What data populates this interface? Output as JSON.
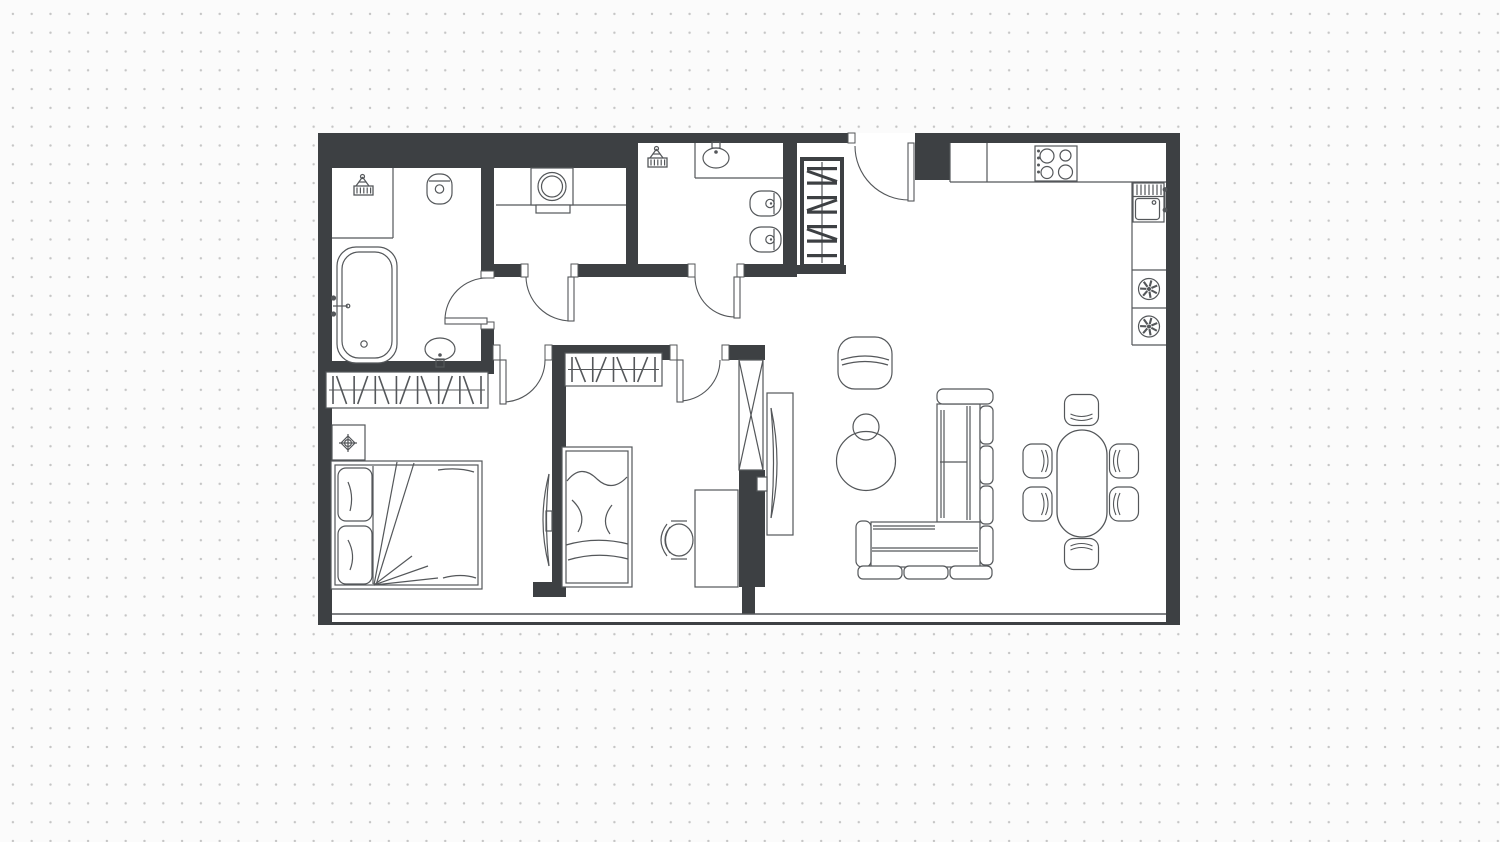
{
  "palette": {
    "page_bg": "#fbfbfb",
    "dot": "#c5c5c5",
    "wall": "#3d4043",
    "line": "#54575a",
    "floor": "#ffffff"
  },
  "plan": {
    "x": 318,
    "y": 133,
    "w": 862,
    "h": 492
  },
  "walls": [
    [
      318,
      133,
      14,
      492
    ],
    [
      318,
      133,
      315,
      35
    ],
    [
      626,
      133,
      229,
      10
    ],
    [
      915,
      133,
      35,
      47
    ],
    [
      950,
      133,
      230,
      10
    ],
    [
      1166,
      133,
      14,
      492
    ],
    [
      481,
      133,
      13,
      145
    ],
    [
      481,
      322,
      13,
      52
    ],
    [
      626,
      143,
      12,
      134
    ],
    [
      783,
      133,
      14,
      144
    ],
    [
      481,
      264,
      47,
      13
    ],
    [
      571,
      264,
      124,
      13
    ],
    [
      737,
      264,
      60,
      13
    ],
    [
      797,
      265,
      49,
      9
    ],
    [
      318,
      361,
      176,
      13
    ],
    [
      481,
      345,
      19,
      15
    ],
    [
      545,
      345,
      132,
      15
    ],
    [
      722,
      345,
      43,
      15
    ],
    [
      552,
      358,
      14,
      239
    ],
    [
      533,
      582,
      33,
      15
    ],
    [
      739,
      470,
      26,
      117
    ],
    [
      742,
      587,
      13,
      27
    ]
  ],
  "window_band": {
    "inner": [
      332,
      614,
      1166,
      614
    ],
    "outer": [
      318,
      623.5,
      1180,
      623.5
    ],
    "inner_w": 1.4,
    "outer_w": 3
  },
  "rooms": [
    {
      "name": "bathroom-1",
      "x": 332,
      "y": 168,
      "w": 149,
      "h": 193
    },
    {
      "name": "laundry-room",
      "x": 494,
      "y": 168,
      "w": 132,
      "h": 96
    },
    {
      "name": "bathroom-2",
      "x": 638,
      "y": 143,
      "w": 145,
      "h": 121
    },
    {
      "name": "entry-hall",
      "x": 800,
      "y": 143,
      "w": 115,
      "h": 130
    },
    {
      "name": "kitchen",
      "x": 950,
      "y": 143,
      "w": 216,
      "h": 202
    },
    {
      "name": "hallway",
      "x": 494,
      "y": 277,
      "w": 271,
      "h": 68
    },
    {
      "name": "master-bedroom",
      "x": 332,
      "y": 374,
      "w": 220,
      "h": 240
    },
    {
      "name": "bedroom-2",
      "x": 566,
      "y": 360,
      "w": 173,
      "h": 254
    },
    {
      "name": "living-dining-room",
      "x": 765,
      "y": 277,
      "w": 401,
      "h": 337
    }
  ],
  "doors": [
    {
      "name": "entry-door",
      "jambs": [
        [
          848,
          133,
          7,
          10
        ]
      ],
      "leaf": [
        908,
        143,
        6,
        58
      ],
      "arc": "M855,146 A54,54 0 0 0 909,200"
    },
    {
      "name": "laundry-door",
      "jambs": [
        [
          521,
          264,
          7,
          13
        ],
        [
          571,
          264,
          7,
          13
        ]
      ],
      "leaf": [
        568,
        277,
        6,
        44
      ],
      "arc": "M526,277 A45,45 0 0 0 571,321"
    },
    {
      "name": "bathroom2-door",
      "jambs": [
        [
          688,
          264,
          7,
          13
        ],
        [
          737,
          264,
          7,
          13
        ]
      ],
      "leaf": [
        734,
        277,
        6,
        41
      ],
      "arc": "M695,277 A40,40 0 0 0 735,317"
    },
    {
      "name": "master-bedroom-door",
      "jambs": [
        [
          493,
          345,
          7,
          15
        ],
        [
          545,
          345,
          7,
          15
        ]
      ],
      "leaf": [
        500,
        360,
        6,
        44
      ],
      "arc": "M545,360 A42,42 0 0 1 503,402"
    },
    {
      "name": "bedroom2-door",
      "jambs": [
        [
          670,
          345,
          7,
          15
        ],
        [
          722,
          345,
          7,
          15
        ]
      ],
      "leaf": [
        677,
        360,
        6,
        42
      ],
      "arc": "M720,360 A41,41 0 0 1 679,401"
    },
    {
      "name": "bathroom1-door",
      "jambs": [
        [
          481,
          271,
          13,
          7
        ],
        [
          481,
          322,
          13,
          7
        ]
      ],
      "leaf": [
        445,
        318,
        42,
        6
      ],
      "arc": "M445,320 A42,42 0 0 1 487,278"
    }
  ],
  "furniture": [
    {
      "type": "shower",
      "name": "shower-head-1",
      "x": 352,
      "y": 174
    },
    {
      "type": "composite",
      "name": "shower-screen-1",
      "lines": [
        [
          393,
          168,
          393,
          238
        ],
        [
          332,
          238,
          393,
          238
        ]
      ]
    },
    {
      "type": "composite",
      "name": "toilet-1",
      "fill": "#ffffff",
      "rrects": [
        [
          427,
          174,
          25,
          30,
          11
        ]
      ],
      "lines": [
        [
          429,
          181,
          450,
          181
        ]
      ],
      "circles": [
        [
          439.5,
          189,
          4.2
        ]
      ]
    },
    {
      "type": "composite",
      "name": "bathtub",
      "fill": "#ffffff",
      "rrects": [
        [
          337,
          247,
          60,
          116,
          19
        ],
        [
          342,
          252,
          50,
          106,
          17
        ]
      ],
      "circles": [
        [
          364,
          344,
          3.2
        ],
        [
          348,
          306,
          1.8
        ]
      ],
      "lines": [
        [
          333,
          306,
          348,
          306
        ]
      ],
      "dots": [
        [
          333.5,
          298,
          2.6
        ],
        [
          333.5,
          314,
          2.6
        ]
      ]
    },
    {
      "type": "composite",
      "name": "sink-1",
      "ellipses": [
        [
          440,
          349,
          15,
          11
        ]
      ],
      "rects": [
        [
          436,
          359,
          8,
          8
        ]
      ],
      "dots": [
        [
          440,
          355,
          1.8
        ]
      ]
    },
    {
      "type": "composite",
      "name": "laundry-counter",
      "lines": [
        [
          496,
          205,
          626,
          205
        ]
      ]
    },
    {
      "type": "composite",
      "name": "washing-machine",
      "fill": "#ffffff",
      "rects": [
        [
          531,
          168,
          42,
          37
        ],
        [
          536,
          205,
          34,
          8
        ]
      ],
      "circles": [
        [
          552,
          186.5,
          14
        ],
        [
          552,
          186.5,
          10.5
        ]
      ]
    },
    {
      "type": "shower",
      "name": "shower-head-2",
      "x": 646,
      "y": 146
    },
    {
      "type": "composite",
      "name": "bathroom2-partition",
      "lines": [
        [
          695,
          143,
          695,
          178
        ],
        [
          695,
          178,
          783,
          178
        ]
      ]
    },
    {
      "type": "composite",
      "name": "sink-2",
      "ellipses": [
        [
          716,
          158,
          13,
          10
        ]
      ],
      "rects": [
        [
          712,
          142,
          8,
          6
        ]
      ],
      "dots": [
        [
          716,
          152,
          1.8
        ]
      ]
    },
    {
      "type": "composite",
      "name": "toilet-2",
      "fill": "#ffffff",
      "rrects": [
        [
          750,
          191,
          31,
          25,
          11
        ]
      ],
      "lines": [
        [
          774,
          193,
          774,
          214
        ]
      ],
      "circles": [
        [
          770,
          203.5,
          4.2
        ]
      ],
      "dots": [
        [
          771,
          203.5,
          1.2
        ]
      ]
    },
    {
      "type": "composite",
      "name": "bidet",
      "fill": "#ffffff",
      "rrects": [
        [
          750,
          227,
          31,
          25,
          11
        ]
      ],
      "lines": [
        [
          774,
          229,
          774,
          250
        ]
      ],
      "circles": [
        [
          770,
          239.5,
          4.2
        ]
      ],
      "dots": [
        [
          771,
          239.5,
          1.2
        ]
      ]
    },
    {
      "type": "shoe_rack",
      "name": "hallway-shoe-rack",
      "x": 800,
      "y": 157,
      "w": 44,
      "h": 111
    },
    {
      "type": "composite",
      "name": "kitchen-counter",
      "lines": [
        [
          950,
          143,
          950,
          182
        ],
        [
          950,
          182,
          1166,
          182
        ],
        [
          987,
          143,
          987,
          182
        ],
        [
          1132,
          182,
          1132,
          345
        ],
        [
          1132,
          345,
          1166,
          345
        ],
        [
          1132,
          270,
          1166,
          270
        ],
        [
          1132,
          308,
          1166,
          308
        ]
      ]
    },
    {
      "type": "composite",
      "name": "cooktop",
      "fill": "#ffffff",
      "rects": [
        [
          1035,
          146,
          42,
          35
        ]
      ],
      "circles": [
        [
          1047,
          156,
          7
        ],
        [
          1065.5,
          155.5,
          5.5
        ],
        [
          1047,
          172.5,
          6
        ],
        [
          1065.5,
          172,
          7
        ]
      ],
      "dots": [
        [
          1038.5,
          151,
          1.5
        ],
        [
          1038.5,
          158,
          1.5
        ],
        [
          1038.5,
          165,
          1.5
        ],
        [
          1038.5,
          172,
          1.5
        ]
      ]
    },
    {
      "type": "composite",
      "name": "kitchen-sink",
      "fill": "#ffffff",
      "rects": [
        [
          1133,
          183,
          31,
          39
        ]
      ],
      "rrects": [
        [
          1135.5,
          198.5,
          24,
          21,
          3
        ]
      ],
      "lines": [
        [
          1133,
          196.5,
          1164,
          196.5
        ],
        [
          1137,
          184.5,
          1137,
          195
        ],
        [
          1141,
          184.5,
          1141,
          195
        ],
        [
          1145,
          184.5,
          1145,
          195
        ],
        [
          1149,
          184.5,
          1149,
          195
        ],
        [
          1153,
          184.5,
          1153,
          195
        ],
        [
          1157,
          184.5,
          1157,
          195
        ],
        [
          1161,
          184.5,
          1161,
          195
        ],
        [
          1165,
          190,
          1165,
          210
        ]
      ],
      "circles": [
        [
          1154,
          202.5,
          1.8
        ]
      ],
      "dots": [
        [
          1165,
          189.5,
          2.4
        ],
        [
          1165,
          210,
          2.4
        ]
      ]
    },
    {
      "type": "fan",
      "name": "appliance-fan-1",
      "cx": 1149,
      "cy": 289,
      "r": 10.5
    },
    {
      "type": "fan",
      "name": "appliance-fan-2",
      "cx": 1149,
      "cy": 326.5,
      "r": 10.5
    },
    {
      "type": "wardrobe",
      "name": "master-wardrobe",
      "x": 326,
      "y": 372,
      "w": 162,
      "h": 36
    },
    {
      "type": "composite",
      "name": "nightstand-lamp",
      "fill": "#ffffff",
      "rects": [
        [
          332,
          425,
          33,
          35
        ]
      ],
      "paths": [
        "M348,436 L355,443 L348,450 L341,443 Z"
      ],
      "lines": [
        [
          348,
          434,
          348,
          452
        ],
        [
          339,
          443,
          357,
          443
        ]
      ],
      "circles": [
        [
          348,
          443,
          3.4
        ]
      ]
    },
    {
      "type": "composite",
      "name": "double-bed",
      "fill": "#ffffff",
      "rects": [
        [
          331,
          461,
          151,
          128
        ],
        [
          335,
          465,
          143,
          120
        ]
      ],
      "rrects": [
        [
          338,
          468,
          34,
          53,
          8
        ],
        [
          338,
          526,
          34,
          58,
          8
        ]
      ],
      "lines": [
        [
          373,
          466,
          373,
          584
        ]
      ],
      "paths": [
        "M397,462 L374,585",
        "M414,463 L376,585",
        "M374,585 L412,556",
        "M374,585 L428,566",
        "M374,585 L438,578",
        "M348,482 Q354,496 350,511",
        "M348,540 Q356,555 350,570",
        "M438,470 Q458,467 474,472",
        "M443,578 Q461,573 476,578"
      ]
    },
    {
      "type": "composite",
      "name": "master-tv",
      "fill": "#ffffff",
      "rects": [
        [
          546,
          511,
          6,
          20
        ]
      ],
      "paths": [
        "M549,474 Q537,520 549,566",
        "M549,474 Q544,520 549,566"
      ]
    },
    {
      "type": "wardrobe",
      "name": "bedroom2-wardrobe",
      "x": 565,
      "y": 353,
      "w": 97,
      "h": 33
    },
    {
      "type": "composite",
      "name": "single-bed",
      "fill": "#ffffff",
      "rects": [
        [
          562,
          447,
          70,
          140
        ],
        [
          566,
          451,
          62,
          132
        ]
      ],
      "paths": [
        "M567,481 Q581,463 597,479 Q612,493 627,477",
        "M566,545 Q597,536 628,544",
        "M568,560 Q598,551 628,559",
        "M572,500 Q588,515 578,532",
        "M612,505 Q600,520 610,534"
      ]
    },
    {
      "type": "composite",
      "name": "desk",
      "fill": "#ffffff",
      "rects": [
        [
          695,
          490,
          43,
          97
        ]
      ]
    },
    {
      "type": "composite",
      "name": "desk-chair",
      "fill": "#ffffff",
      "ellipses": [
        [
          679,
          540,
          14,
          16
        ]
      ],
      "paths": [
        "M667,524 Q655,540 667,556",
        "M670,527 Q661,540 670,553"
      ],
      "lines": [
        [
          671,
          521,
          687,
          521
        ],
        [
          671,
          559,
          687,
          559
        ]
      ]
    },
    {
      "type": "composite",
      "name": "built-in-closet",
      "fill": "#ffffff",
      "rects": [
        [
          739,
          360,
          24,
          110
        ]
      ],
      "lines": [
        [
          739,
          360,
          763,
          470
        ],
        [
          763,
          360,
          739,
          470
        ]
      ]
    },
    {
      "type": "composite",
      "name": "living-tv",
      "fill": "#ffffff",
      "rects": [
        [
          767,
          393,
          26,
          142
        ],
        [
          757,
          477,
          10,
          14
        ]
      ],
      "paths": [
        "M771,408 Q783,463 771,518",
        "M771,408 Q776,463 771,518"
      ]
    },
    {
      "type": "composite",
      "name": "armchair",
      "fill": "#ffffff",
      "rrects": [
        [
          838,
          337,
          54,
          52,
          17
        ]
      ],
      "paths": [
        "M841,360 Q865,352 889,360",
        "M842,365 Q865,358 888,365"
      ]
    },
    {
      "type": "composite",
      "name": "coffee-tables",
      "circles": [
        [
          866,
          461,
          29.5
        ],
        [
          866,
          427,
          13
        ]
      ]
    },
    {
      "type": "composite",
      "name": "corner-sofa",
      "fill": "#ffffff",
      "rects": [
        [
          937,
          404,
          43,
          118
        ],
        [
          871,
          522,
          109,
          45
        ]
      ],
      "rrects": [
        [
          937,
          389,
          56,
          15,
          6
        ],
        [
          856,
          521,
          15,
          46,
          6
        ],
        [
          980,
          406,
          13,
          38,
          5
        ],
        [
          980,
          446,
          13,
          38,
          5
        ],
        [
          980,
          486,
          13,
          38,
          5
        ],
        [
          980,
          526,
          13,
          39,
          5
        ],
        [
          858,
          566,
          44,
          13,
          5
        ],
        [
          904,
          566,
          44,
          13,
          5
        ],
        [
          950,
          566,
          42,
          13,
          5
        ]
      ],
      "lines": [
        [
          941,
          410,
          941,
          518
        ],
        [
          944,
          410,
          944,
          518
        ],
        [
          967,
          406,
          967,
          520
        ],
        [
          970,
          406,
          970,
          520
        ],
        [
          873,
          526,
          935,
          526
        ],
        [
          873,
          529,
          935,
          529
        ],
        [
          872,
          548,
          978,
          548
        ],
        [
          872,
          551,
          978,
          551
        ],
        [
          940,
          462,
          967,
          462
        ]
      ]
    },
    {
      "type": "dining_set",
      "name": "dining-set",
      "table": [
        1057,
        430,
        50,
        107
      ],
      "chairs": [
        [
          1081.5,
          410,
          "down"
        ],
        [
          1081.5,
          554,
          "up"
        ],
        [
          1037.5,
          461,
          "right"
        ],
        [
          1037.5,
          504,
          "right"
        ],
        [
          1124,
          461,
          "left"
        ],
        [
          1124,
          504,
          "left"
        ]
      ]
    }
  ]
}
